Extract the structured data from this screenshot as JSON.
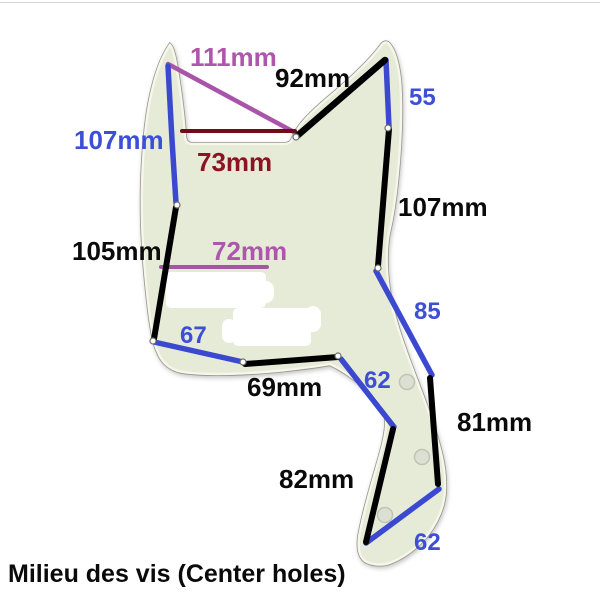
{
  "caption": "Milieu des vis (Center holes)",
  "subject": "bass-pickguard-screw-hole-spacing-diagram",
  "colors": {
    "blue": "#3c4fd6",
    "purple": "#ae56ae",
    "dark_red": "#8e1322",
    "black": "#0a0a0a",
    "pickguard_fill": "#e6ebd7",
    "pickguard_edge": "#97978f"
  },
  "measurements": [
    {
      "id": "d111",
      "label": "111mm",
      "color_name": "purple"
    },
    {
      "id": "d92",
      "label": "92mm",
      "color_name": "black"
    },
    {
      "id": "d55",
      "label": "55",
      "color_name": "blue"
    },
    {
      "id": "d107L",
      "label": "107mm",
      "color_name": "blue"
    },
    {
      "id": "d73",
      "label": "73mm",
      "color_name": "dark-red"
    },
    {
      "id": "d107R",
      "label": "107mm",
      "color_name": "black"
    },
    {
      "id": "d105",
      "label": "105mm",
      "color_name": "black"
    },
    {
      "id": "d72",
      "label": "72mm",
      "color_name": "purple"
    },
    {
      "id": "d67",
      "label": "67",
      "color_name": "blue"
    },
    {
      "id": "d69",
      "label": "69mm",
      "color_name": "black"
    },
    {
      "id": "d62a",
      "label": "62",
      "color_name": "blue"
    },
    {
      "id": "d85",
      "label": "85",
      "color_name": "blue"
    },
    {
      "id": "d81",
      "label": "81mm",
      "color_name": "black"
    },
    {
      "id": "d82",
      "label": "82mm",
      "color_name": "black"
    },
    {
      "id": "d62b",
      "label": "62",
      "color_name": "blue"
    }
  ]
}
